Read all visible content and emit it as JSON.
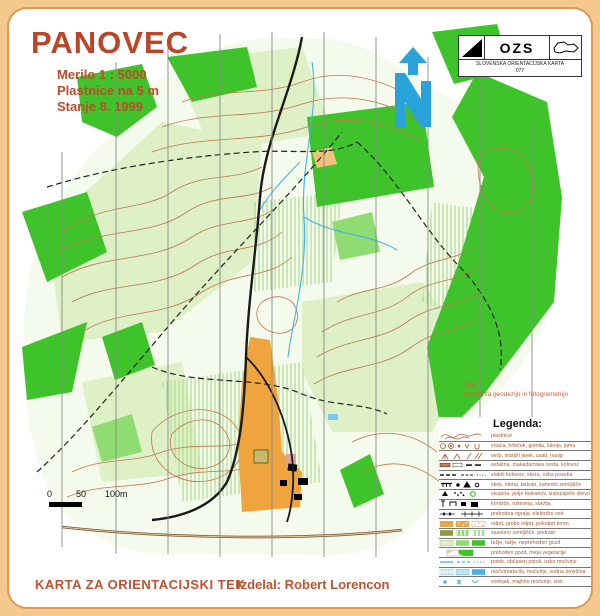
{
  "header": {
    "title": "PANOVEC",
    "subtitle_lines": [
      "Merilo 1 : 5000",
      "Plastnice na 5 m",
      "Stanje 8. 1999"
    ]
  },
  "logo_box": {
    "org": "OZS",
    "caption_line1": "SLOVENSKA ORIENTACIJSKA KARTA",
    "caption_line2": "077"
  },
  "north_arrow": {
    "label": "N"
  },
  "print_credit": {
    "label": "Tisk:",
    "value": "Inštitut za geodezijo in fotogrametrijo"
  },
  "scale_bar": {
    "labels": [
      "0",
      "50",
      "100m"
    ]
  },
  "legend": {
    "title": "Legenda:",
    "items": [
      {
        "symbol": "contours",
        "label": "plastnice"
      },
      {
        "symbol": "depression-knoll-pit",
        "label": "vrtača, hribček, gomila, luknja, jama"
      },
      {
        "symbol": "gully-erosion",
        "label": "večji, manjši jarek, usad, nasip"
      },
      {
        "symbol": "roads",
        "label": "asfaltna, makadamska cesta, kolovoz"
      },
      {
        "symbol": "paths",
        "label": "slabši kolovoz, steza, ozka poseka"
      },
      {
        "symbol": "cliff-boulder-stony",
        "label": "skok, stena, balvan, kamnito zemljišče"
      },
      {
        "symbol": "boulder-field-tree",
        "label": "skupina, polje balvanov, izstopajoče drevo"
      },
      {
        "symbol": "feeder-ruin-building",
        "label": "krmišče, ruševina, stavba"
      },
      {
        "symbol": "fence-powerline",
        "label": "prehodna ograja, električni vod"
      },
      {
        "symbol": "open-terrain",
        "label": "odprt, grobo odprt, polodprt teren"
      },
      {
        "symbol": "private-undergrowth",
        "label": "zasebno zemljišče, podrast"
      },
      {
        "symbol": "forest-runability",
        "label": "težje, lažje, neprehoden gozd"
      },
      {
        "symbol": "open-forest-veg-boundary",
        "label": "prehoden gozd, meja vegetacije"
      },
      {
        "symbol": "streams",
        "label": "potok, občasen potok, ozko močvirje"
      },
      {
        "symbol": "marsh-water",
        "label": "močvirnata tla, močvirje, vodna površina"
      },
      {
        "symbol": "well-spring",
        "label": "vodnjak, majhno močvirje, izvir"
      }
    ]
  },
  "footer": {
    "left": "KARTA ZA ORIENTACIJSKI TEK",
    "right": "Izdelal: Robert Lorencon"
  },
  "colors": {
    "page_bg": "#F5C98E",
    "card_border": "#DC9A58",
    "title_red": "#BC4528",
    "footer_red": "#C2512F",
    "legend_text": "#A85C36",
    "forest_green": "#3EC32A",
    "pale_green": "#DDF0C6",
    "contour_brown": "#C4744A",
    "open_orange": "#F0A43E",
    "water_blue": "#45B3E8",
    "north_arrow_blue": "#2AA3DB"
  }
}
